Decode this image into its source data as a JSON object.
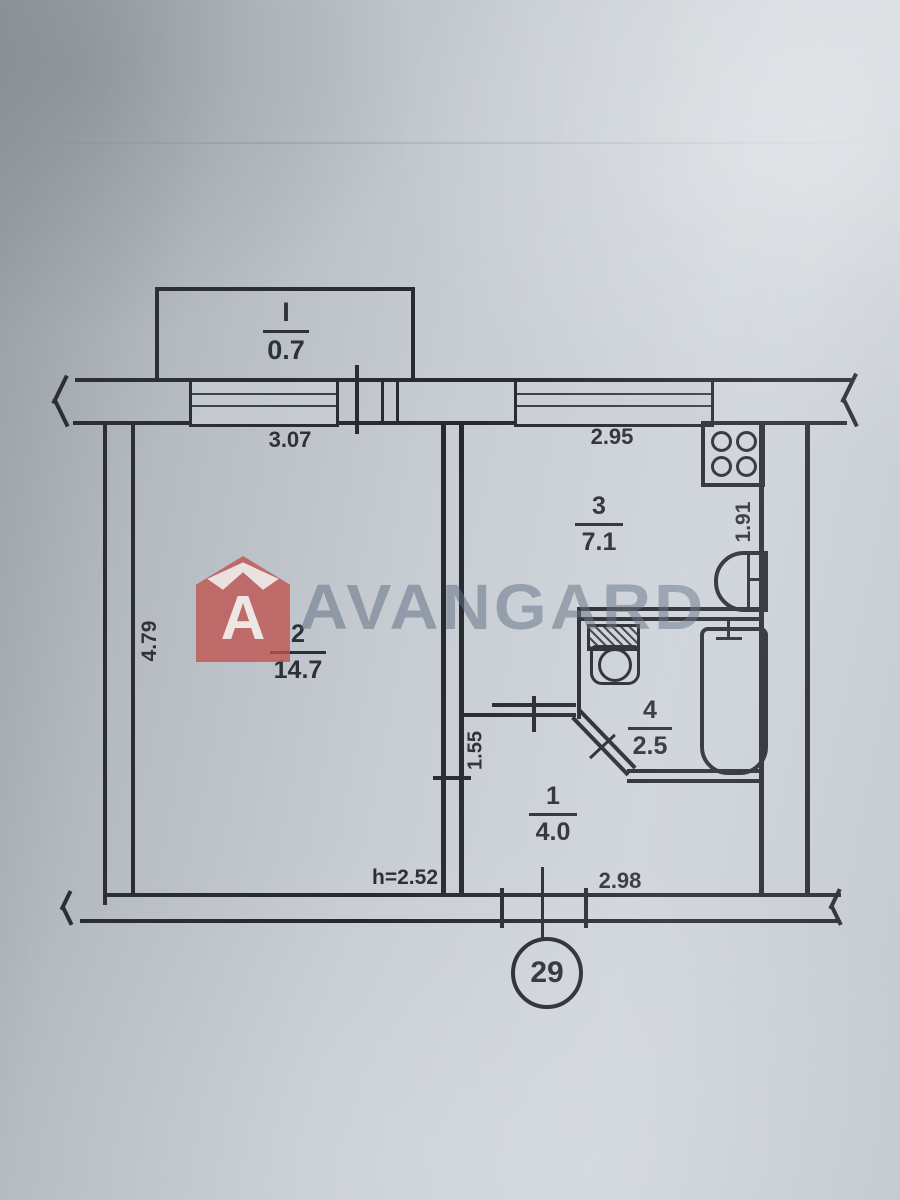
{
  "watermark": {
    "brand": "AVANGARD",
    "logo_letter": "A",
    "logo_color": "#c1504b",
    "text_color": "#606e82"
  },
  "balcony": {
    "number": "I",
    "area": "0.7"
  },
  "rooms": {
    "living": {
      "number": "2",
      "area": "14.7"
    },
    "kitchen": {
      "number": "3",
      "area": "7.1"
    },
    "bathroom": {
      "number": "4",
      "area": "2.5"
    },
    "hallway": {
      "number": "1",
      "area": "4.0"
    }
  },
  "dimensions": {
    "window_left": "3.07",
    "window_right": "2.95",
    "kitchen_depth": "1.91",
    "room_depth": "4.79",
    "hall_wall": "1.55",
    "ceiling_height": "h=2.52",
    "hall_width": "2.98"
  },
  "apartment_number": "29"
}
